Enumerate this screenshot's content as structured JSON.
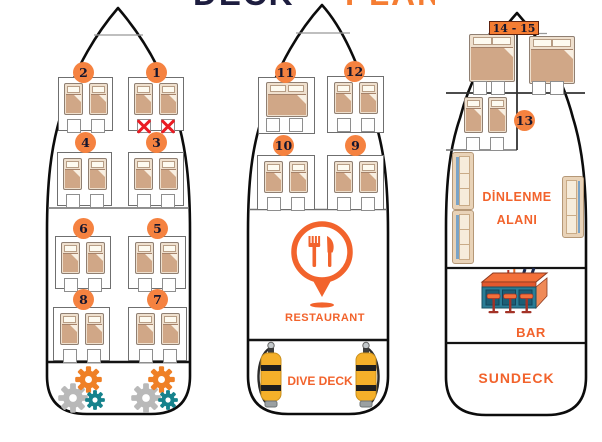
{
  "title": {
    "word_dark": "DECK",
    "word_orange": "PLAN"
  },
  "cabins": [
    {
      "number": "1",
      "beds": "twin",
      "red_x_marked": true
    },
    {
      "number": "2",
      "beds": "twin"
    },
    {
      "number": "3",
      "beds": "twin"
    },
    {
      "number": "4",
      "beds": "twin"
    },
    {
      "number": "5",
      "beds": "twin"
    },
    {
      "number": "6",
      "beds": "twin"
    },
    {
      "number": "7",
      "beds": "twin"
    },
    {
      "number": "8",
      "beds": "twin"
    },
    {
      "number": "9",
      "beds": "twin"
    },
    {
      "number": "10",
      "beds": "twin"
    },
    {
      "number": "11",
      "beds": "double"
    },
    {
      "number": "12",
      "beds": "twin"
    },
    {
      "number": "13",
      "beds": "twin"
    },
    {
      "number": "14",
      "beds": "double"
    },
    {
      "number": "15",
      "beds": "double"
    }
  ],
  "labels": {
    "cabins_14_15": "14 - 15",
    "restaurant": "RESTAURANT",
    "dive_deck": "DIVE DECK",
    "lounge_line1": "DİNLENME",
    "lounge_line2": "ALANI",
    "bar": "BAR",
    "sundeck": "SUNDECK"
  },
  "icons": [
    "fork-knife-pin-icon",
    "dive-tank-icon",
    "gear-icon",
    "bar-counter-icon",
    "red-x-mark",
    "sofa",
    "single-bed",
    "double-bed"
  ],
  "colors": {
    "accent_orange": "#f2632c",
    "circle_orange": "#f58240",
    "number_navy": "#16162e",
    "red_x": "#ea1b23",
    "bed_tan": "#d0a787",
    "tank_yellow": "#f5b02a",
    "gear_teal": "#15828c",
    "gear_gray": "#b9b9b9",
    "gear_orange": "#ef8026",
    "bar_teal": "#2a7d96",
    "sofa_tan": "#e9d3b8",
    "hull_black": "#0c0c0c"
  }
}
